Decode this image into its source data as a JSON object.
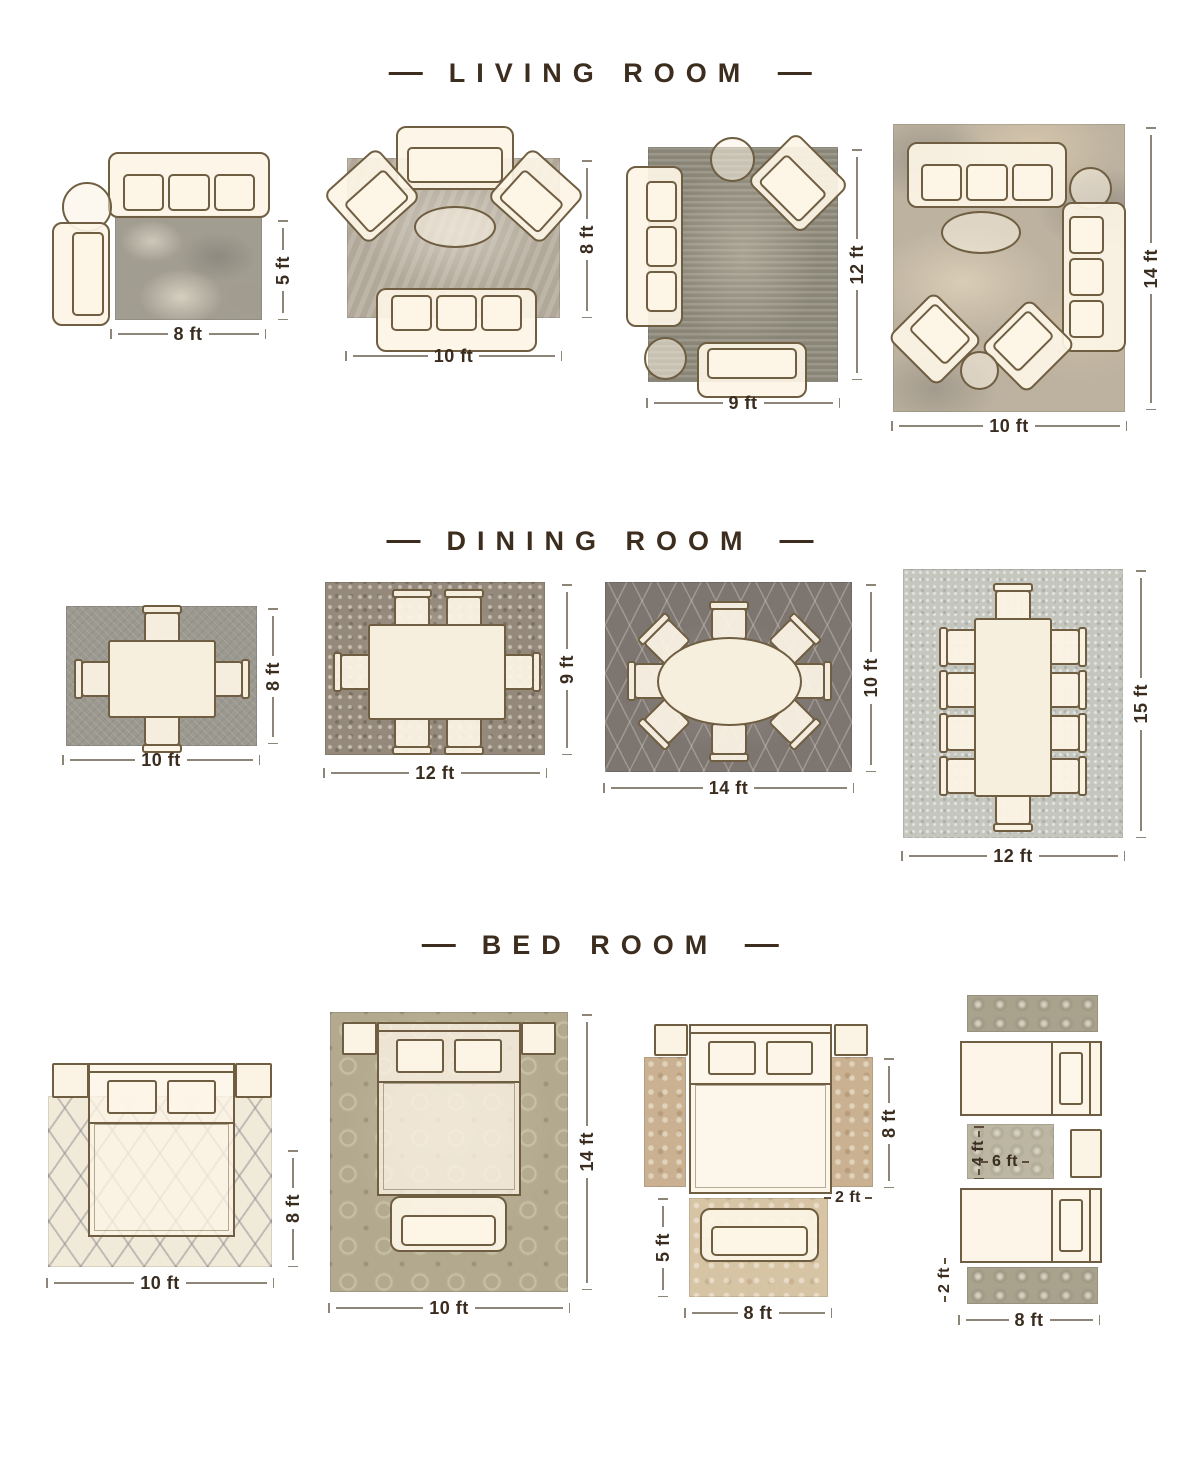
{
  "page": {
    "background": "#ffffff"
  },
  "palette": {
    "furniture_outline": "#6f5e41",
    "furniture_fill": "#fdf5e6",
    "dimension_line": "#8d8577",
    "dimension_text": "#3a2d20",
    "header_text": "#3c2d1e"
  },
  "sections": [
    {
      "title": "LIVING ROOM",
      "layouts": [
        {
          "width_label": "8 ft",
          "height_label": "5 ft"
        },
        {
          "width_label": "10 ft",
          "height_label": "8 ft"
        },
        {
          "width_label": "9 ft",
          "height_label": "12 ft"
        },
        {
          "width_label": "10 ft",
          "height_label": "14 ft"
        }
      ]
    },
    {
      "title": "DINING ROOM",
      "layouts": [
        {
          "width_label": "10 ft",
          "height_label": "8 ft"
        },
        {
          "width_label": "12 ft",
          "height_label": "9 ft"
        },
        {
          "width_label": "14 ft",
          "height_label": "10 ft"
        },
        {
          "width_label": "12 ft",
          "height_label": "15 ft"
        }
      ]
    },
    {
      "title": "BED ROOM",
      "layouts": [
        {
          "width_label": "10 ft",
          "height_label": "8 ft"
        },
        {
          "width_label": "10 ft",
          "height_label": "14 ft"
        },
        {
          "side_runner_height_label": "8 ft",
          "side_runner_width_label": "2 ft",
          "foot_rug_height_label": "5 ft",
          "foot_rug_width_label": "8 ft"
        },
        {
          "between_rug_height_label": "4 ft",
          "between_rug_width_label": "6 ft",
          "runner_width_label": "2 ft",
          "runner_length_label": "8 ft"
        }
      ]
    }
  ]
}
